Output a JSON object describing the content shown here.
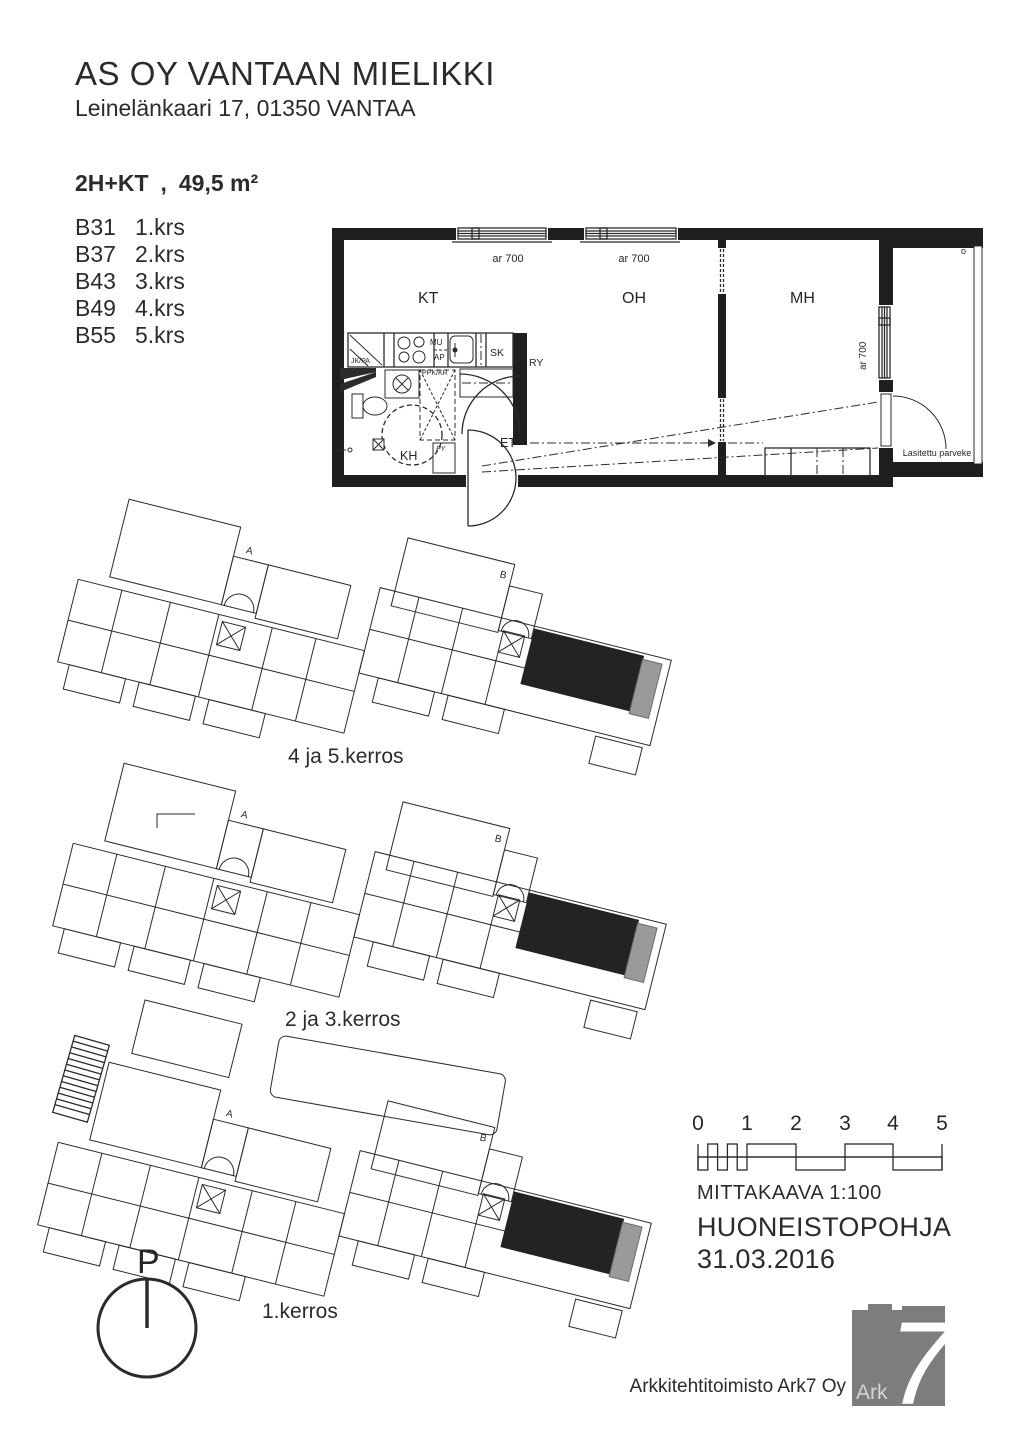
{
  "header": {
    "title": "AS OY VANTAAN MIELIKKI",
    "address": "Leinelänkaari 17, 01350  VANTAA"
  },
  "apartment": {
    "type": "2H+KT",
    "separator": ",",
    "area": "49,5 m²",
    "units": [
      {
        "unit": "B31",
        "floor": "1.krs"
      },
      {
        "unit": "B37",
        "floor": "2.krs"
      },
      {
        "unit": "B43",
        "floor": "3.krs"
      },
      {
        "unit": "B49",
        "floor": "4.krs"
      },
      {
        "unit": "B55",
        "floor": "5.krs"
      }
    ]
  },
  "floorplan": {
    "rooms": {
      "kt": "KT",
      "oh": "OH",
      "mh": "MH",
      "kh": "KH",
      "et": "ET"
    },
    "closets": {
      "sk": "SK",
      "ry": "RY"
    },
    "fixtures": {
      "jkpa": "JK/PA",
      "mu": "MU",
      "ap": "AP",
      "ppkkr": "PPK/KR",
      "py": "PY"
    },
    "windows": {
      "top_left": "ar 700",
      "top_right": "ar 700",
      "mh": "ar 700"
    },
    "balcony": {
      "label": "Lasitettu parveke",
      "marker": "o"
    }
  },
  "siteplans": [
    {
      "label": "4 ja 5.kerros"
    },
    {
      "label": "2 ja 3.kerros"
    },
    {
      "label": "1.kerros"
    }
  ],
  "stairwells": {
    "a": "A",
    "b": "B"
  },
  "north": {
    "label": "P"
  },
  "scalebar": {
    "ticks": [
      "0",
      "1",
      "2",
      "3",
      "4",
      "5"
    ],
    "caption": "MITTAKAAVA  1:100"
  },
  "titleblock": {
    "doc_type": "HUONEISTOPOHJA",
    "date": "31.03.2016"
  },
  "footer": {
    "firm": "Arkkitehtitoimisto Ark7 Oy",
    "logo_text": "Ark",
    "logo_numeral": "7"
  },
  "colors": {
    "ink": "#2b2b2b",
    "highlight_fill": "#232323",
    "balcony_gray": "#9a9a9a",
    "logo_gray": "#7d7d7d"
  }
}
